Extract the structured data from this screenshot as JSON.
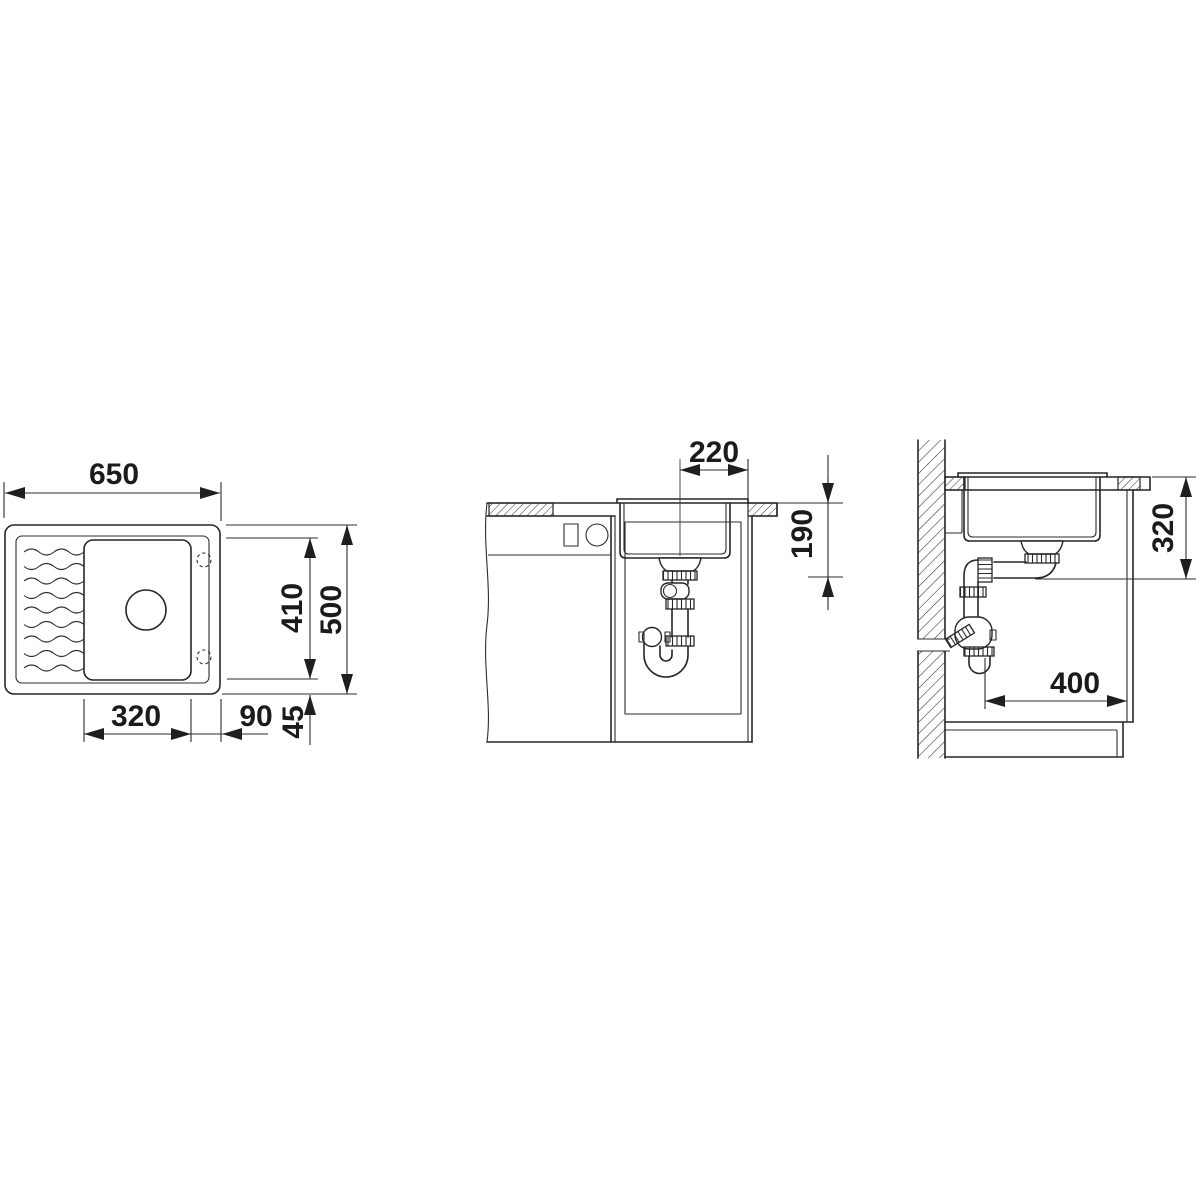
{
  "views": {
    "top_view": {
      "dims": {
        "width": "650",
        "depth": "500",
        "inner_depth": "410",
        "bowl_width": "320",
        "bowl_to_edge": "90",
        "rim_margin": "45"
      }
    },
    "front_section": {
      "dims": {
        "drain_offset": "220",
        "bowl_depth": "190"
      }
    },
    "side_section": {
      "dims": {
        "outlet_height": "320",
        "wall_clearance": "400"
      }
    }
  },
  "colors": {
    "line": "#262626",
    "background": "#ffffff"
  }
}
